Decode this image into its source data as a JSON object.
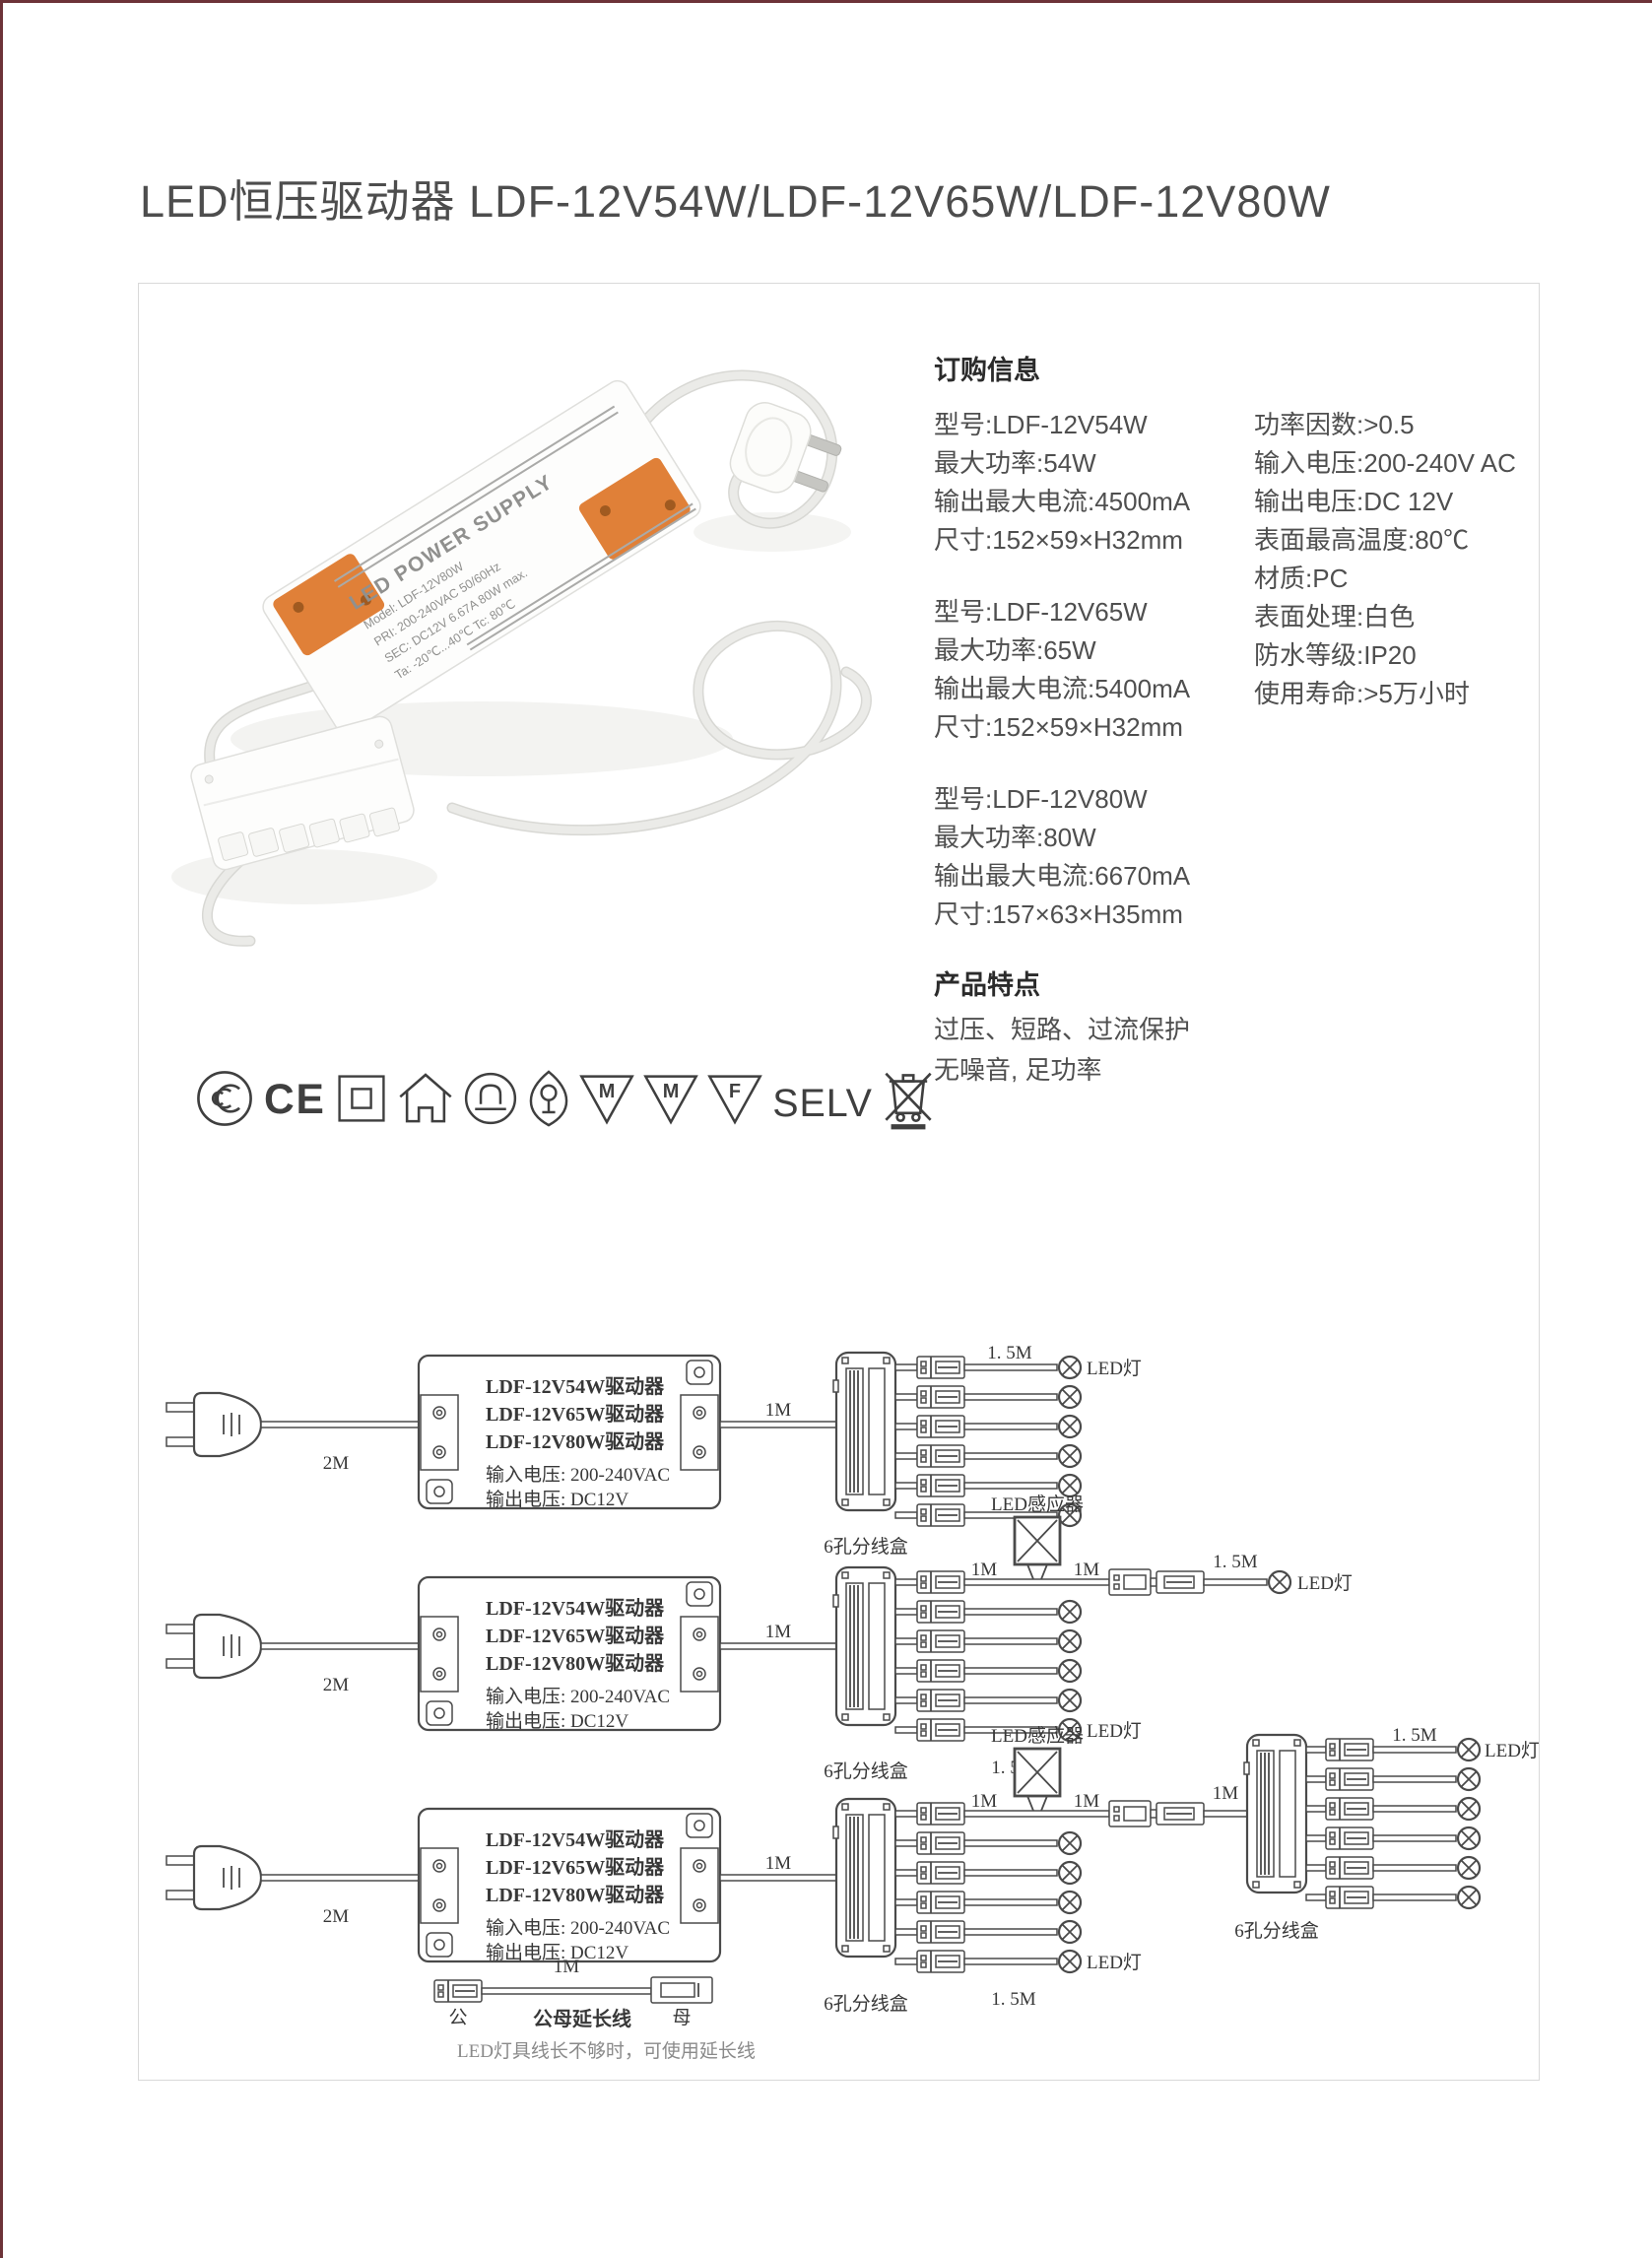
{
  "page": {
    "title": "LED恒压驱动器 LDF-12V54W/LDF-12V65W/LDF-12V80W"
  },
  "colors": {
    "accent_border": "#6d3338",
    "device_orange": "#e08038",
    "box_border": "#d9d9d9"
  },
  "ordering": {
    "heading": "订购信息",
    "col1": [
      {
        "lines": [
          "型号:LDF-12V54W",
          "最大功率:54W",
          "输出最大电流:4500mA",
          "尺寸:152×59×H32mm"
        ]
      },
      {
        "lines": [
          "型号:LDF-12V65W",
          "最大功率:65W",
          "输出最大电流:5400mA",
          "尺寸:152×59×H32mm"
        ]
      },
      {
        "lines": [
          "型号:LDF-12V80W",
          "最大功率:80W",
          "输出最大电流:6670mA",
          "尺寸:157×63×H35mm"
        ]
      }
    ],
    "col2": [
      "功率因数:>0.5",
      "输入电压:200-240V AC",
      "输出电压:DC 12V",
      "表面最高温度:80℃",
      "材质:PC",
      "表面处理:白色",
      "防水等级:IP20",
      "使用寿命:>5万小时"
    ]
  },
  "features": {
    "heading": "产品特点",
    "lines": [
      "过压、短路、过流保护",
      "无噪音, 足功率"
    ]
  },
  "certifications": {
    "ce": "CE",
    "m1": "M",
    "m2": "M",
    "f": "F",
    "selv": "SELV"
  },
  "photo": {
    "label_title": "LED POWER SUPPLY",
    "label_lines": [
      "Model: LDF-12V80W",
      "PRI: 200-240VAC  50/60Hz",
      "SEC: DC12V 6.67A 80W max.",
      "Ta: -20℃...40℃  Tc: 80℃"
    ]
  },
  "diagrams": {
    "driver_lines": [
      "LDF-12V54W驱动器",
      "LDF-12V65W驱动器",
      "LDF-12V80W驱动器",
      "输入电压: 200-240VAC",
      "输出电压:  DC12V"
    ],
    "labels": {
      "m2": "2M",
      "m1": "1M",
      "m15": "1. 5M",
      "led": "LED灯",
      "splitter": "6孔分线盒",
      "sensor": "LED感应器",
      "male": "公",
      "female": "母",
      "ext": "公母延长线"
    },
    "note": "LED灯具线长不够时，可使用延长线"
  }
}
